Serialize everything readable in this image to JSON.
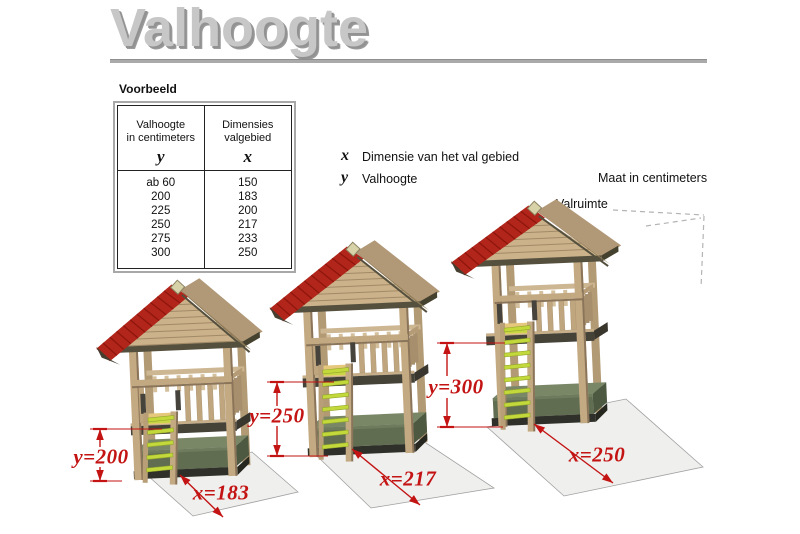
{
  "title": "Valhoogte",
  "example": {
    "label": "Voorbeeld",
    "table": {
      "columns": [
        {
          "header_line1": "Valhoogte",
          "header_line2": "in centimeters",
          "symbol": "y"
        },
        {
          "header_line1": "Dimensies",
          "header_line2": "valgebied",
          "symbol": "x"
        }
      ],
      "rows": [
        {
          "valhoogte": "ab 60",
          "dimensies": "150"
        },
        {
          "valhoogte": "200",
          "dimensies": "183"
        },
        {
          "valhoogte": "225",
          "dimensies": "200"
        },
        {
          "valhoogte": "250",
          "dimensies": "217"
        },
        {
          "valhoogte": "275",
          "dimensies": "233"
        },
        {
          "valhoogte": "300",
          "dimensies": "250"
        }
      ]
    }
  },
  "legend": {
    "x_symbol": "x",
    "x_label": "Dimensie van het val gebied",
    "y_symbol": "y",
    "y_label": "Valhoogte"
  },
  "units_note": "Maat in centimeters",
  "fall_space_label": "Valruimte",
  "houses": [
    {
      "y_label": "y=200",
      "x_label": "x=183",
      "y_value": 200,
      "x_value": 183
    },
    {
      "y_label": "y=250",
      "x_label": "x=217",
      "y_value": 250,
      "x_value": 217
    },
    {
      "y_label": "y=300",
      "x_label": "x=250",
      "y_value": 300,
      "x_value": 250
    }
  ],
  "colors": {
    "dimension_red": "#c31313",
    "roof_red": "#b1251a",
    "wood_tan": "#c4aa82",
    "ladder_green": "#c3d83a",
    "mat_green": "#6f7d5e",
    "fall_mat_gray": "#efefed",
    "title_gray": "#c7c7c7"
  }
}
